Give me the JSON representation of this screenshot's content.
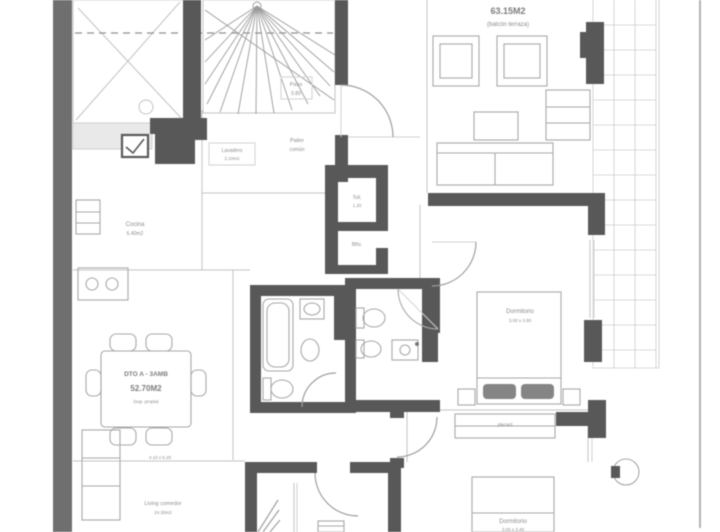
{
  "title": "apartment-floor-plan",
  "colors": {
    "wall_dark": "#585858",
    "wall_outer": "#6f6f6f",
    "line_light": "#c3c3c3",
    "line_medium": "#9f9f9f",
    "text_gray": "#8c8c8c",
    "background": "#ffffff"
  },
  "labels": {
    "area_top": "63.15M2",
    "area_top_sub": "(balcón terraza)",
    "paso_1": "Paso",
    "paso_2": "0.80",
    "palier_1": "Palier",
    "palier_2": "común",
    "lavadero_1": "Lavadero",
    "lavadero_2": "2.10m2",
    "cocina_1": "Cocina",
    "cocina_2": "6.40m2",
    "toilette_1": "Toil.",
    "toilette_2": "1.20",
    "bano_1": "Bño.",
    "unit_1": "DTO A - 3AMB",
    "unit_2": "52.70M2",
    "unit_3": "(sup. propia)",
    "dining_dim": "4.10 x 5.20",
    "living_1": "Living comedor",
    "living_2": "24.30m2",
    "dorm1_1": "Dormitorio",
    "dorm1_2": "3.00 x 3.60",
    "dorm2_1": "Dormitorio",
    "dorm2_2": "3.00 x 3.40",
    "placard": "placard"
  }
}
